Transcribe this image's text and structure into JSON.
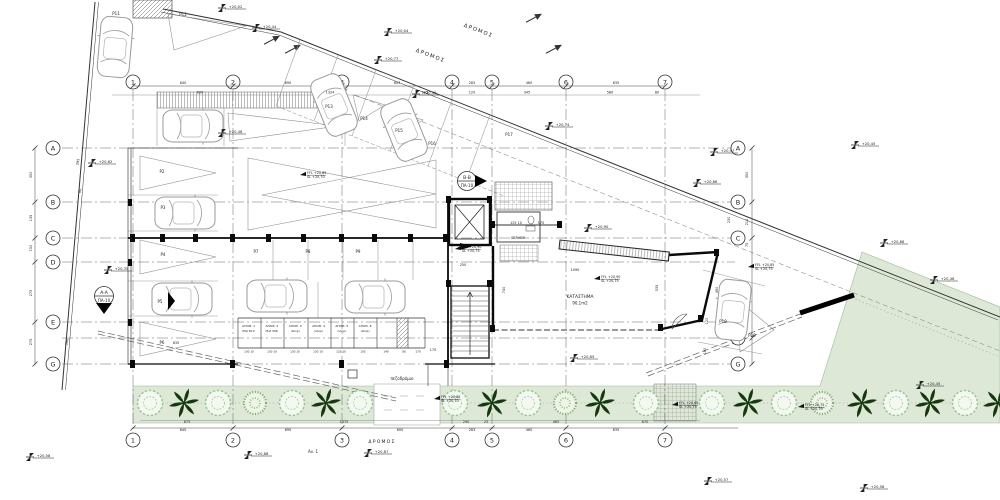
{
  "drawing": {
    "type": "architectural ground floor site plan",
    "road_label": "ΔΡΟΜΟΣ",
    "sidewalk_label": "πεζοδρόμιο",
    "note_label": "Αν. 1",
    "rooms": {
      "server": "SERVER",
      "shop": "ΚΑΤΑΣΤΗΜΑ",
      "shop_area": "90,1m2"
    },
    "sections": {
      "a": {
        "name": "A-A",
        "sheet": "ΠΑ-10"
      },
      "b": {
        "name": "B-B",
        "sheet": "ΠΑ-10"
      }
    }
  },
  "colors": {
    "green_fill": "#dde9d6",
    "tree": "#9cc497",
    "bush": "#79a86b",
    "palm": "#16380f",
    "line": "#444444",
    "wall": "#0a0a0a"
  },
  "grid": {
    "cols": [
      {
        "label": "1",
        "x": 133
      },
      {
        "label": "2",
        "x": 233
      },
      {
        "label": "3",
        "x": 342
      },
      {
        "label": "4",
        "x": 452
      },
      {
        "label": "5",
        "x": 492
      },
      {
        "label": "6",
        "x": 566
      },
      {
        "label": "7",
        "x": 665
      }
    ],
    "rows": [
      {
        "label": "A",
        "y": 148,
        "left": 1,
        "right": 1
      },
      {
        "label": "B",
        "y": 202,
        "left": 1,
        "right": 1
      },
      {
        "label": "C",
        "y": 238,
        "left": 1,
        "right": 1
      },
      {
        "label": "D",
        "y": 262,
        "left": 1,
        "right": 0
      },
      {
        "label": "E",
        "y": 322,
        "left": 1,
        "right": 0
      },
      {
        "label": "F",
        "y": 338,
        "left": 0,
        "right": 1
      },
      {
        "label": "G",
        "y": 364,
        "left": 1,
        "right": 1
      }
    ]
  },
  "storage": {
    "units": [
      {
        "name": "ΑΠΟΘ. 1",
        "tag": "(flat 301)"
      },
      {
        "name": "ΑΠΟΘ. 2",
        "tag": "(flat 304)"
      },
      {
        "name": "ΑΠΟΘ. 3",
        "tag": "(shop)"
      },
      {
        "name": "ΑΠΟΘ. 4",
        "tag": "(shop)"
      },
      {
        "name": "ΑΠΟΘ. 5",
        "tag": "(shop)"
      },
      {
        "name": "ΑΠΟΘ. 6",
        "tag": "(shop)"
      }
    ],
    "cell_dims": [
      "130 10",
      "130 10",
      "130 10",
      "130 10",
      "125 10",
      "105",
      "140",
      "80",
      "170"
    ],
    "cell_dim_xs": [
      249,
      272,
      295,
      318,
      341,
      363,
      386,
      404,
      418
    ]
  },
  "parking_labels": [
    {
      "t": "P2",
      "x": 162,
      "y": 173
    },
    {
      "t": "P3",
      "x": 163,
      "y": 209
    },
    {
      "t": "P4",
      "x": 163,
      "y": 256
    },
    {
      "t": "P5",
      "x": 160,
      "y": 303
    },
    {
      "t": "P6",
      "x": 162,
      "y": 344
    },
    {
      "t": "P7",
      "x": 256,
      "y": 253
    },
    {
      "t": "P8",
      "x": 308,
      "y": 253
    },
    {
      "t": "P9",
      "x": 358,
      "y": 253
    },
    {
      "t": "P11",
      "x": 116,
      "y": 15
    },
    {
      "t": "P12",
      "x": 183,
      "y": 16
    },
    {
      "t": "P13",
      "x": 329,
      "y": 108
    },
    {
      "t": "P14",
      "x": 364,
      "y": 120
    },
    {
      "t": "P15",
      "x": 399,
      "y": 132
    },
    {
      "t": "P16",
      "x": 432,
      "y": 145
    },
    {
      "t": "P17",
      "x": 509,
      "y": 136
    },
    {
      "t": "P18",
      "x": 723,
      "y": 323
    },
    {
      "t": "P19",
      "x": 752,
      "y": 337
    }
  ],
  "levels": [
    {
      "t": "+20,02",
      "x": 222,
      "y": 5
    },
    {
      "t": "+20,44",
      "x": 256,
      "y": 25
    },
    {
      "t": "+20,04",
      "x": 388,
      "y": 29
    },
    {
      "t": "+20,77",
      "x": 378,
      "y": 57
    },
    {
      "t": "+20,40",
      "x": 416,
      "y": 91
    },
    {
      "t": "+20,48",
      "x": 222,
      "y": 130
    },
    {
      "t": "+20,74",
      "x": 549,
      "y": 123
    },
    {
      "t": "+20,97",
      "x": 714,
      "y": 149
    },
    {
      "t": "+20,86",
      "x": 697,
      "y": 180
    },
    {
      "t": "+20,88",
      "x": 884,
      "y": 240
    },
    {
      "t": "+20,46",
      "x": 934,
      "y": 277
    },
    {
      "t": "+20,45",
      "x": 855,
      "y": 142
    },
    {
      "t": "+20,62",
      "x": 92,
      "y": 160
    },
    {
      "t": "+20,35",
      "x": 108,
      "y": 267
    },
    {
      "t": "+20,90",
      "x": 588,
      "y": 225
    },
    {
      "t": "+20,65",
      "x": 574,
      "y": 355
    },
    {
      "t": "+20,45",
      "x": 920,
      "y": 382
    },
    {
      "t": "+20,88",
      "x": 248,
      "y": 452
    },
    {
      "t": "+20,87",
      "x": 368,
      "y": 450
    },
    {
      "t": "+20,57",
      "x": 708,
      "y": 478
    },
    {
      "t": "+20,58",
      "x": 864,
      "y": 485
    },
    {
      "t": "+20,58",
      "x": 30,
      "y": 454
    }
  ],
  "ffl_markers": [
    {
      "a": "FFL +20,90",
      "b": "SL +20,75",
      "x": 455,
      "y": 249
    },
    {
      "a": "FFL +20,90",
      "b": "SL +20,75",
      "x": 594,
      "y": 279
    },
    {
      "a": "FFL +20,85",
      "b": "SL +20,70",
      "x": 300,
      "y": 175
    },
    {
      "a": "FFL +20,85",
      "b": "SL +20,75",
      "x": 748,
      "y": 267
    },
    {
      "a": "FFL +20,85",
      "b": "SL +20,75",
      "x": 672,
      "y": 405
    },
    {
      "a": "FFL +20,75",
      "b": "SL +20,70",
      "x": 798,
      "y": 407
    },
    {
      "a": "FFL +20,85",
      "b": "SL +20,70",
      "x": 434,
      "y": 399
    }
  ],
  "dimensions": [
    {
      "t": "840",
      "x": 183,
      "y": 84
    },
    {
      "t": "690",
      "x": 288,
      "y": 84
    },
    {
      "t": "603",
      "x": 397,
      "y": 84
    },
    {
      "t": "283",
      "x": 472,
      "y": 84
    },
    {
      "t": "460",
      "x": 529,
      "y": 84
    },
    {
      "t": "635",
      "x": 616,
      "y": 84
    },
    {
      "t": "690",
      "x": 200,
      "y": 93.5
    },
    {
      "t": "1324",
      "x": 330,
      "y": 93.5
    },
    {
      "t": "293",
      "x": 425,
      "y": 93.5
    },
    {
      "t": "120",
      "x": 472,
      "y": 93.5
    },
    {
      "t": "345",
      "x": 527,
      "y": 93.5
    },
    {
      "t": "580",
      "x": 610,
      "y": 93.5
    },
    {
      "t": "80",
      "x": 657,
      "y": 93.5
    },
    {
      "t": "640",
      "x": 183,
      "y": 431
    },
    {
      "t": "690",
      "x": 288,
      "y": 431
    },
    {
      "t": "600",
      "x": 400,
      "y": 431
    },
    {
      "t": "283",
      "x": 472,
      "y": 431
    },
    {
      "t": "460",
      "x": 529,
      "y": 431
    },
    {
      "t": "635",
      "x": 616,
      "y": 431
    },
    {
      "t": "875",
      "x": 187,
      "y": 423
    },
    {
      "t": "1375",
      "x": 344,
      "y": 423
    },
    {
      "t": "290",
      "x": 466,
      "y": 423
    },
    {
      "t": "25",
      "x": 486,
      "y": 423
    },
    {
      "t": "465",
      "x": 556,
      "y": 423
    },
    {
      "t": "670",
      "x": 645,
      "y": 423
    },
    {
      "t": "350",
      "x": 32,
      "y": 175,
      "r": -90
    },
    {
      "t": "135",
      "x": 32,
      "y": 218,
      "r": -90
    },
    {
      "t": "150",
      "x": 32,
      "y": 248,
      "r": -90
    },
    {
      "t": "275",
      "x": 32,
      "y": 293,
      "r": -90
    },
    {
      "t": "275",
      "x": 32,
      "y": 342,
      "r": -90
    },
    {
      "t": "350",
      "x": 748,
      "y": 175,
      "r": -90
    },
    {
      "t": "230",
      "x": 730,
      "y": 220,
      "r": -90
    },
    {
      "t": "210",
      "x": 748,
      "y": 222,
      "r": -90
    },
    {
      "t": "75",
      "x": 748,
      "y": 245,
      "r": -90
    },
    {
      "t": "490",
      "x": 718,
      "y": 290,
      "r": -90
    },
    {
      "t": "120",
      "x": 708,
      "y": 321,
      "r": -90
    },
    {
      "t": "180",
      "x": 706,
      "y": 351,
      "r": -90
    },
    {
      "t": "295",
      "x": 79,
      "y": 162,
      "r": -80
    },
    {
      "t": "60",
      "x": 81,
      "y": 191,
      "r": -80
    },
    {
      "t": "180",
      "x": 68,
      "y": 342,
      "r": -80
    },
    {
      "t": "250",
      "x": 463,
      "y": 266
    },
    {
      "t": "170",
      "x": 433,
      "y": 351
    },
    {
      "t": "1090",
      "x": 575,
      "y": 271
    },
    {
      "t": "740",
      "x": 505,
      "y": 290,
      "r": -90
    },
    {
      "t": "535",
      "x": 658,
      "y": 288,
      "r": -90
    },
    {
      "t": "835",
      "x": 176,
      "y": 344
    },
    {
      "t": "125 10",
      "x": 516,
      "y": 224
    },
    {
      "t": "170",
      "x": 541,
      "y": 224
    }
  ],
  "landscape": {
    "strip_y": 403,
    "round_trees": [
      150,
      218,
      292,
      360,
      455,
      528,
      646,
      712,
      784,
      896,
      965
    ],
    "palms": [
      184,
      326,
      492,
      600,
      748,
      862,
      930,
      998
    ],
    "bushes": [
      255,
      565,
      822
    ]
  }
}
